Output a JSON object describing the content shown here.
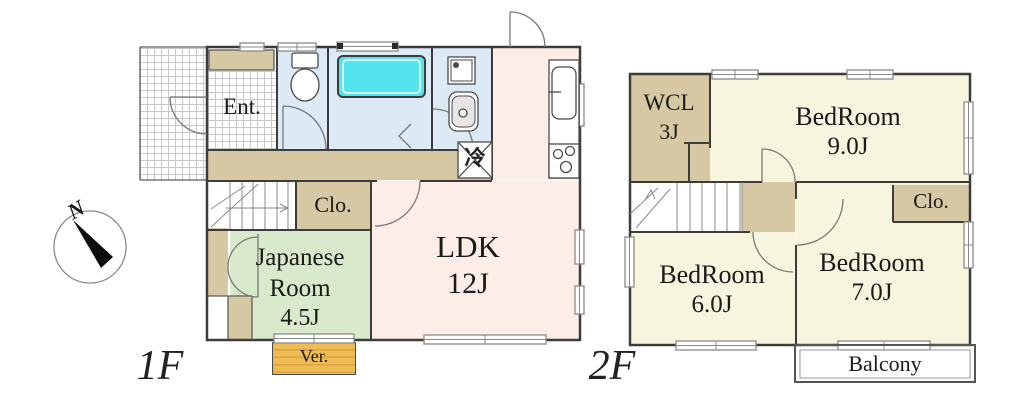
{
  "compass": {
    "label": "N"
  },
  "floor1": {
    "label": "1F",
    "entrance": "Ent.",
    "closet": "Clo.",
    "japanese_room": {
      "line1": "Japanese",
      "line2": "Room",
      "size": "4.5J"
    },
    "ldk": {
      "name": "LDK",
      "size": "12J"
    },
    "veranda": "Ver.",
    "refrigerator": "冷"
  },
  "floor2": {
    "label": "2F",
    "wcl": {
      "name": "WCL",
      "size": "3J"
    },
    "bedroom_9": {
      "name": "BedRoom",
      "size": "9.0J"
    },
    "bedroom_6": {
      "name": "BedRoom",
      "size": "6.0J"
    },
    "bedroom_7": {
      "name": "BedRoom",
      "size": "7.0J"
    },
    "closet": "Clo.",
    "balcony": "Balcony"
  },
  "colors": {
    "wall": "#3c3c3c",
    "tan": "#d6c8a2",
    "cream": "#f8f5df",
    "pink": "#fceee7",
    "green": "#d9e9cc",
    "blue": "#dceaf6",
    "tub": "#54e4ee",
    "ver": "#f0bb55"
  }
}
